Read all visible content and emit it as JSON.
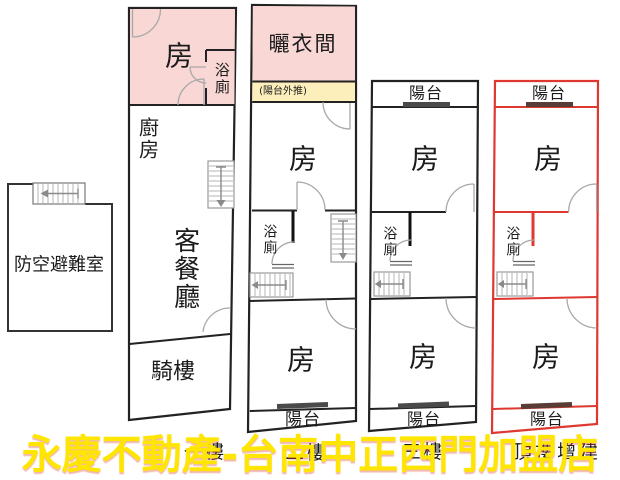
{
  "watermark": {
    "text": "永慶不動產-台南中正西門加盟店",
    "color": "#ffe600"
  },
  "shelter": {
    "label": "防空避難室"
  },
  "plans": {
    "p1": {
      "floor_label": "一樓",
      "room": "房",
      "bath": "浴廁",
      "kitchen": "廚房",
      "living_dining": "客餐廳",
      "arcade": "騎樓"
    },
    "p2": {
      "floor_label": "二樓",
      "drying_room": "曬衣間",
      "balcony_note": "(陽台外推)",
      "room_upper": "房",
      "bath": "浴廁",
      "room_lower": "房",
      "balcony_bottom": "陽台"
    },
    "p3": {
      "floor_label": "三樓",
      "balcony_top": "陽台",
      "room_upper": "房",
      "bath": "浴廁",
      "room_lower": "房",
      "balcony_bottom": "陽台"
    },
    "p4": {
      "floor_label": "頂樓增建",
      "balcony_top": "陽台",
      "room_upper": "房",
      "bath": "浴廁",
      "room_lower": "房",
      "balcony_bottom": "陽台"
    }
  },
  "colors": {
    "wall": "#222222",
    "highlight_outline": "#de3831",
    "room_fill_pink": "#f8d7d5",
    "note_fill_yellow": "#fcefbc",
    "window_bar": "#4a4a4a",
    "watermark_yellow": "#ffe600"
  }
}
